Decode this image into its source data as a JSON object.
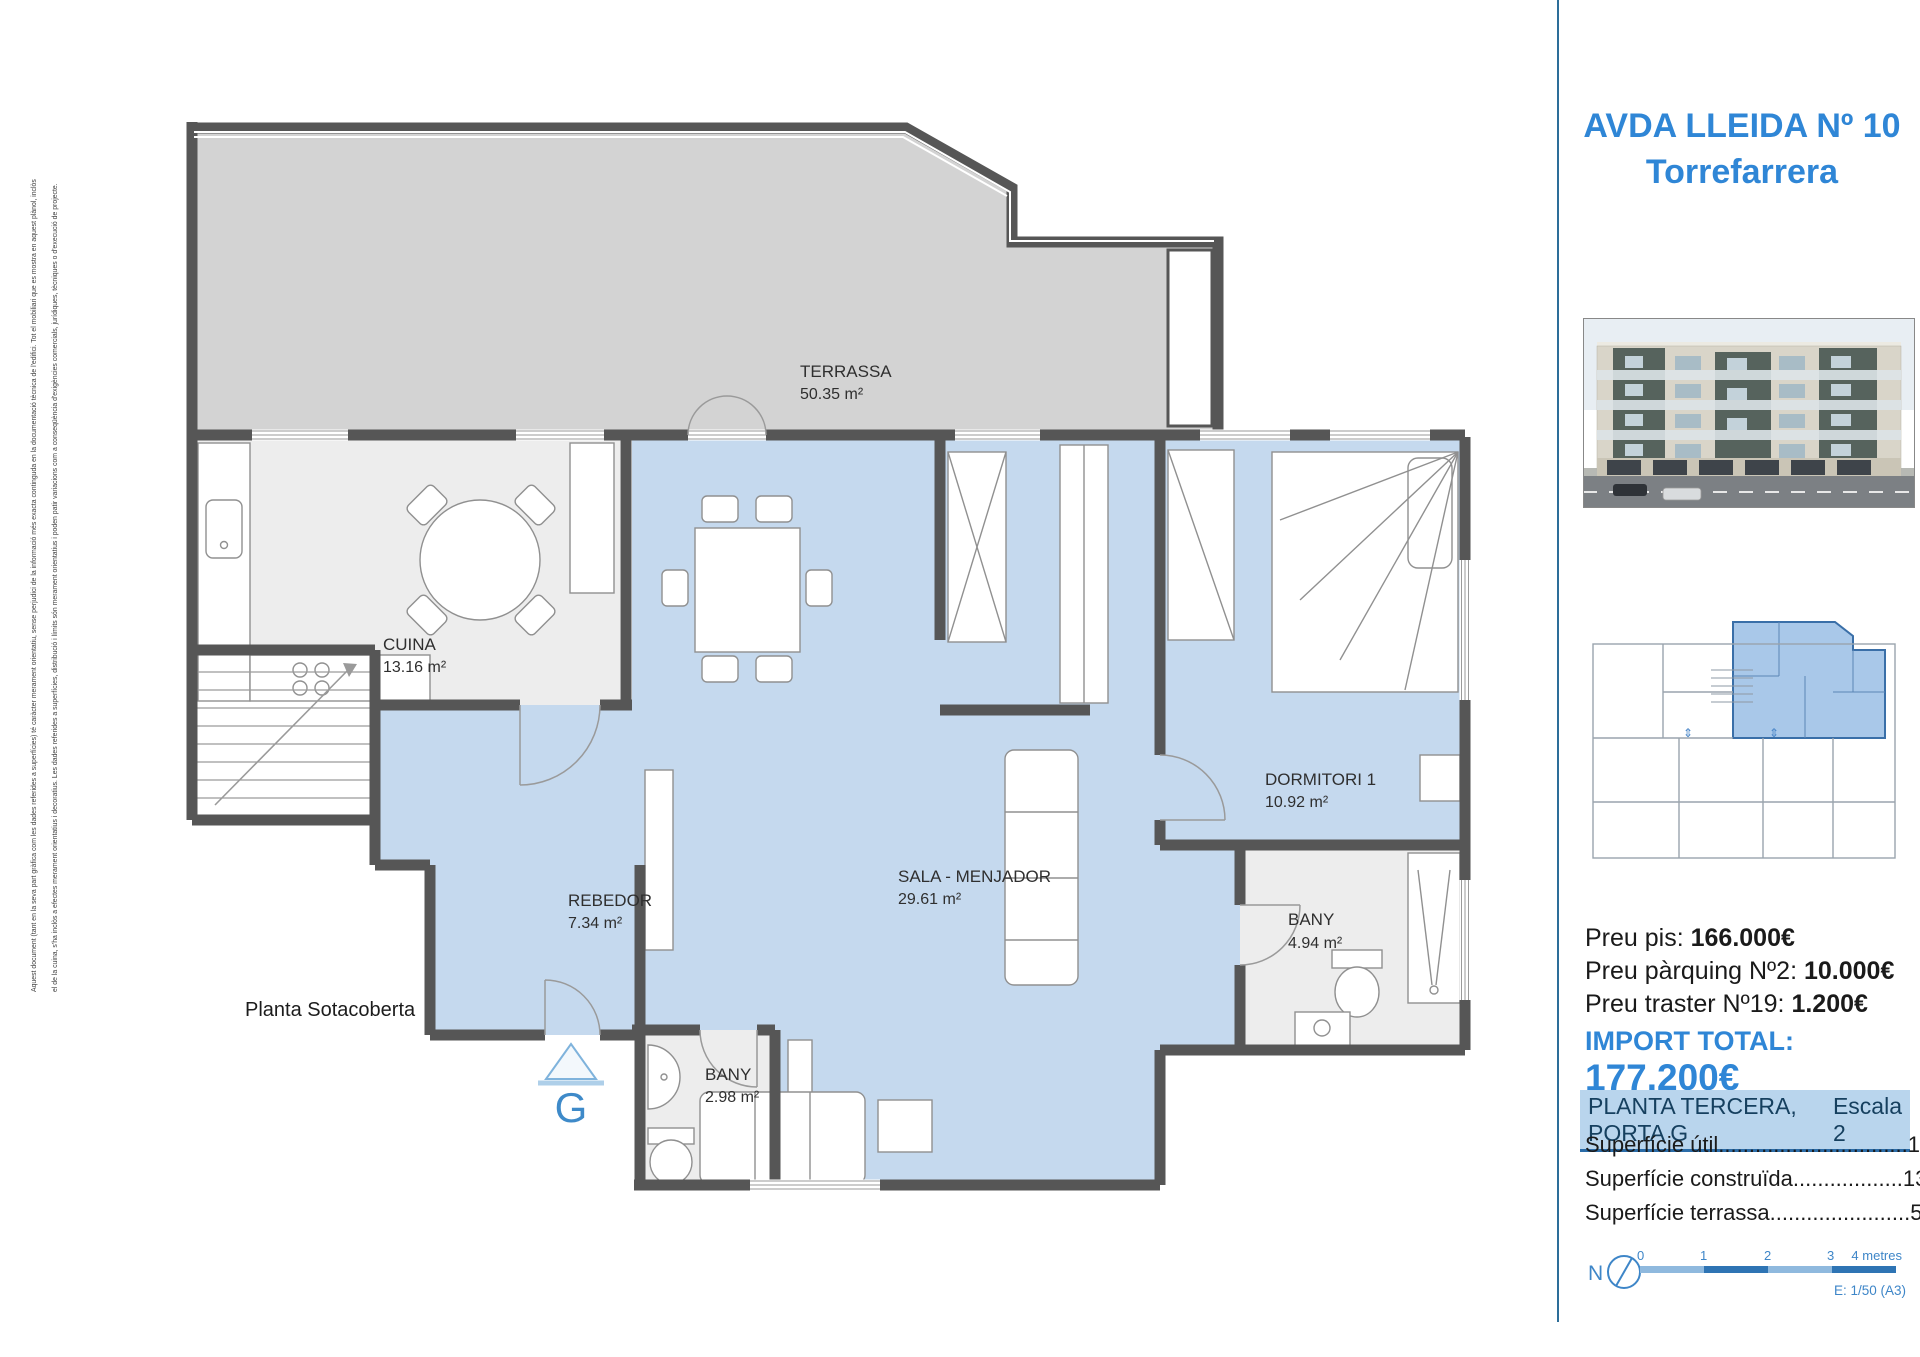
{
  "disclaimer": {
    "line1": "Aquest document (tant en la seva part gràfica com les dades referides a superfícies) té caràcter merament orientatiu, sense perjudici de la informació més exacta continguda en la documentació tècnica de l'edifici. Tot el mobiliari que es mostra en aquest plànol, inclòs",
    "line2": "el de la cuina, s'ha inclòs a efectes merament orientatius i decoratius. Les dades referides a superfícies, distribució i límits són merament orientatius i poden patir variacions com a conseqüència d'exigències comercials, jurídiques, tècniques o d'execució de projecte."
  },
  "floorplan": {
    "rooms": [
      {
        "name": "TERRASSA",
        "area": "50.35 m²"
      },
      {
        "name": "CUINA",
        "area": "13.16 m²"
      },
      {
        "name": "SALA - MENJADOR",
        "area": "29.61 m²"
      },
      {
        "name": "REBEDOR",
        "area": "7.34 m²"
      },
      {
        "name": "DORMITORI 1",
        "area": "10.92 m²"
      },
      {
        "name": "BANY",
        "area": "4.94 m²"
      },
      {
        "name": "BANY",
        "area": "2.98 m²"
      }
    ],
    "floor_label": "Planta Sotacoberta",
    "entrance_label": "G"
  },
  "sidebar": {
    "title_line1": "AVDA LLEIDA Nº 10",
    "title_line2": "Torrefarrera",
    "prices": [
      {
        "label": "Preu pis: ",
        "value": "166.000€"
      },
      {
        "label": "Preu pàrquing Nº2: ",
        "value": "10.000€"
      },
      {
        "label": "Preu traster Nº19: ",
        "value": "1.200€"
      }
    ],
    "total_label": "IMPORT TOTAL: ",
    "total_value": "177.200€",
    "plan_header": "PLANTA TERCERA, PORTA G",
    "scale_label": "Escala 2",
    "surfaces": [
      {
        "text": "Superfície útil...............................109,58 m²"
      },
      {
        "text": "Superfície construïda..................139,39 m²"
      },
      {
        "text": "Superfície terrassa.......................59,09 m²"
      }
    ],
    "north_label": "N",
    "scalebar": {
      "t0": "0",
      "t1": "1",
      "t2": "2",
      "t3": "3",
      "end": "4 metres"
    },
    "scale_note": "E: 1/50  (A3)",
    "colors": {
      "accent_blue": "#2f86d6",
      "plan_blue": "#c5d9ee",
      "terrace_gray": "#d2d2d2",
      "wall_gray": "#565656"
    }
  }
}
